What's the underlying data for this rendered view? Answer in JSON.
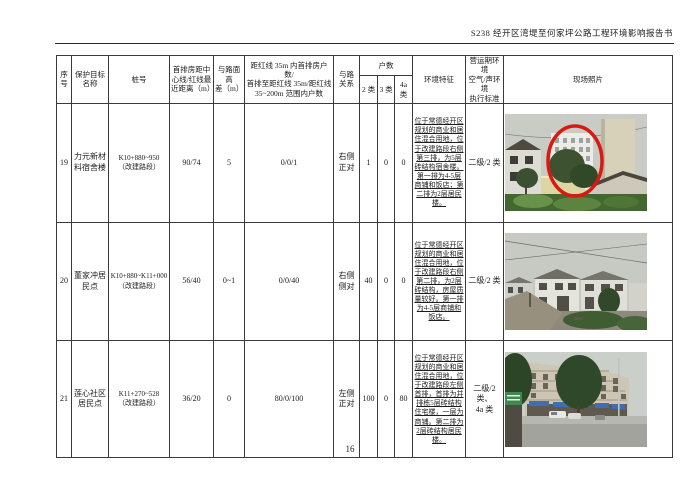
{
  "page": {
    "header_title": "S238 经开区湾堤至何家坪公路工程环境影响报告书",
    "page_number": "16"
  },
  "colors": {
    "annotation_red": "#d81a12",
    "table_border": "#3a3a3a"
  },
  "table": {
    "headers": {
      "col_index": "序\n号",
      "col_name": "保护目标\n名称",
      "col_stake": "桩号",
      "col_distance": "首排房距中\n心线/红线最\n近距离（m）",
      "col_height_diff": "与路面高\n差（m）",
      "col_households_range": "距红线 35m 内首排房户数/\n首排至距红线 35m/距红线\n35~200m 范围内户数",
      "col_road_relation": "与路\n关系",
      "col_households": "户数",
      "col_class2": "2 类",
      "col_class3": "3 类",
      "col_class4a": "4a 类",
      "col_env_features": "环境特征",
      "col_standard": "营运期环境\n空气/声环境\n执行标准",
      "col_photo": "现场照片"
    },
    "rows": [
      {
        "index": "19",
        "name": "力元新材料宿舍楼",
        "stake": "K10+880~950\n（改建路段）",
        "distance": "90/74",
        "height_diff": "5",
        "households_range": "0/0/1",
        "road_relation": "右侧\n正对",
        "class2": "1",
        "class3": "0",
        "class4a": "0",
        "env_features": "位于常德经开区规划的商业和居住混合用地，位于改建路段右侧第三排，为5层砖结构宿舍楼。第一排为4-5层商铺和饭店；第二排为2层居民楼。",
        "standard": "二级/2 类",
        "photo_label": "白色多层宿舍楼（红圈标注），周边树木和民房"
      },
      {
        "index": "20",
        "name": "董家冲居民点",
        "stake": "K10+880~K11+000\n（改建路段）",
        "distance": "56/40",
        "height_diff": "0~1",
        "households_range": "0/0/40",
        "road_relation": "右侧\n侧对",
        "class2": "40",
        "class3": "0",
        "class4a": "0",
        "env_features": "位于常德经开区规划的商业和居住混合用地，位于改建路段右侧第二排，为2层砖结构，房屋质量较好。第一排为4-5层商铺和饭店。",
        "standard": "二级/2 类",
        "photo_label": "董家冲2层居民房及土路现场照片"
      },
      {
        "index": "21",
        "name": "莲心社区居民点",
        "stake": "K11+270~528\n（改建路段）",
        "distance": "36/20",
        "height_diff": "0",
        "households_range": "80/0/100",
        "road_relation": "左侧\n正对",
        "class2": "100",
        "class3": "0",
        "class4a": "80",
        "env_features": "位于常德经开区规划的商业和居住混合用地，位于改建路段左侧首排，首排为并排栋5层砖结构住宅楼，一层为商铺。第二排为2层砖结构居民楼。",
        "standard": "二级/2 类、\n4a 类",
        "photo_label": "莲心社区沿街多层商住楼现场照片"
      }
    ]
  }
}
